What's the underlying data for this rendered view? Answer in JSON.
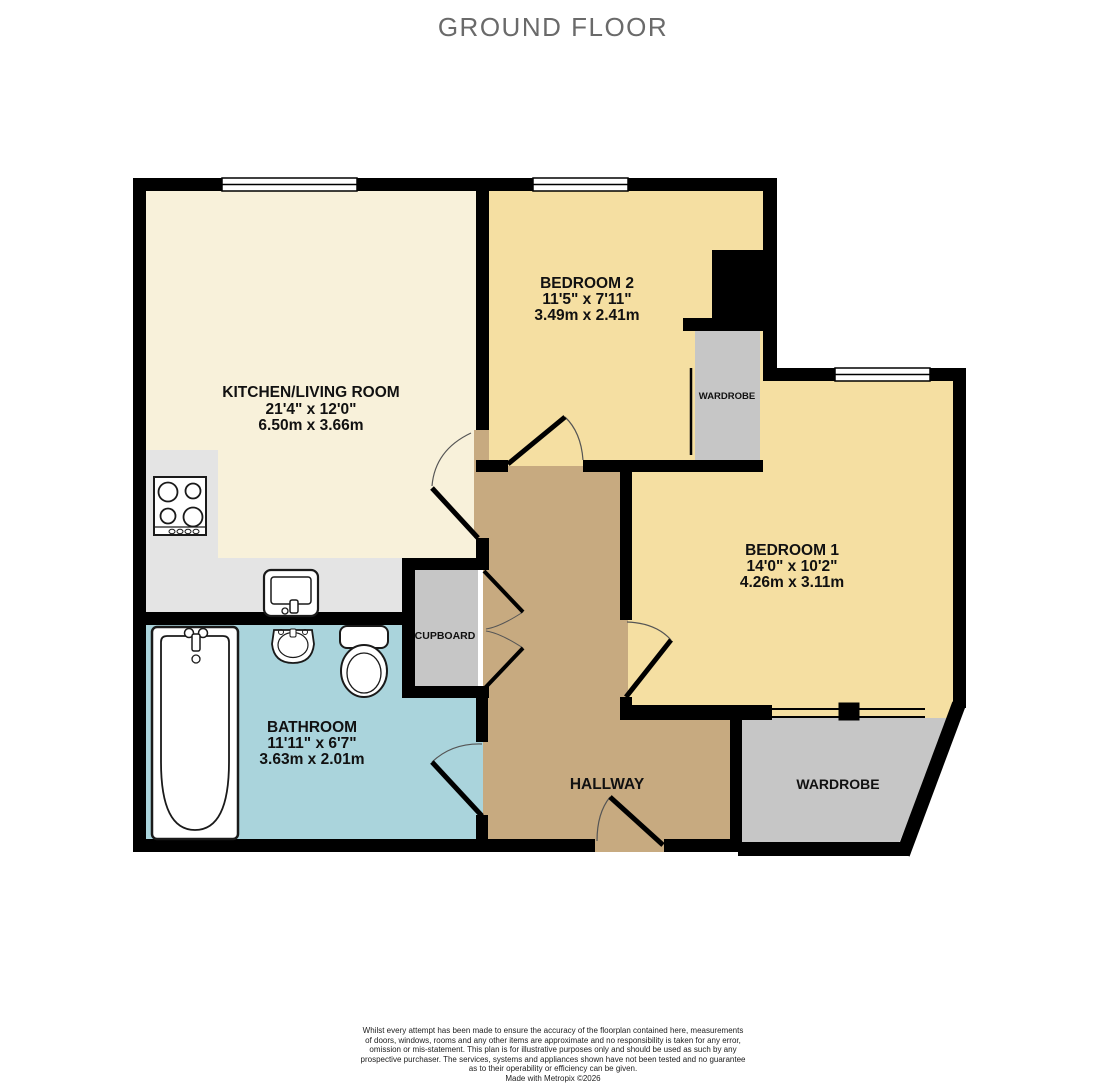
{
  "title": "GROUND FLOOR",
  "colors": {
    "wall": "#000000",
    "kitchen_floor": "#f8f1da",
    "counter": "#e4e4e4",
    "bedroom_floor": "#f5dfa2",
    "bathroom_floor": "#aad4dc",
    "hallway_floor": "#c7aa80",
    "storage_fill": "#c6c6c6",
    "title_color": "#6a6a6a"
  },
  "rooms": [
    {
      "name": "KITCHEN/LIVING ROOM",
      "dim_ft": "21'4\" x 12'0\"",
      "dim_m": "6.50m x 3.66m"
    },
    {
      "name": "BEDROOM 2",
      "dim_ft": "11'5\" x 7'11\"",
      "dim_m": "3.49m x 2.41m"
    },
    {
      "name": "BEDROOM 1",
      "dim_ft": "14'0\" x 10'2\"",
      "dim_m": "4.26m x 3.11m"
    },
    {
      "name": "BATHROOM",
      "dim_ft": "11'11\" x 6'7\"",
      "dim_m": "3.63m x 2.01m"
    },
    {
      "name": "HALLWAY"
    },
    {
      "name": "CUPBOARD"
    },
    {
      "name": "WARDROBE"
    },
    {
      "name": "WARDROBE"
    }
  ],
  "fixtures": [
    "hob",
    "kitchen-sink",
    "bathtub",
    "basin",
    "toilet"
  ],
  "disclaimer": {
    "lines": [
      "Whilst every attempt has been made to ensure the accuracy of the floorplan contained here, measurements",
      "of doors, windows, rooms and any other items are approximate and no responsibility is taken for any error,",
      "omission or mis-statement. This plan is for illustrative purposes only and should be used as such by any",
      "prospective purchaser. The services, systems and appliances shown have not been tested and no guarantee",
      "as to their operability or efficiency can be given.",
      "Made with Metropix ©2026"
    ]
  }
}
